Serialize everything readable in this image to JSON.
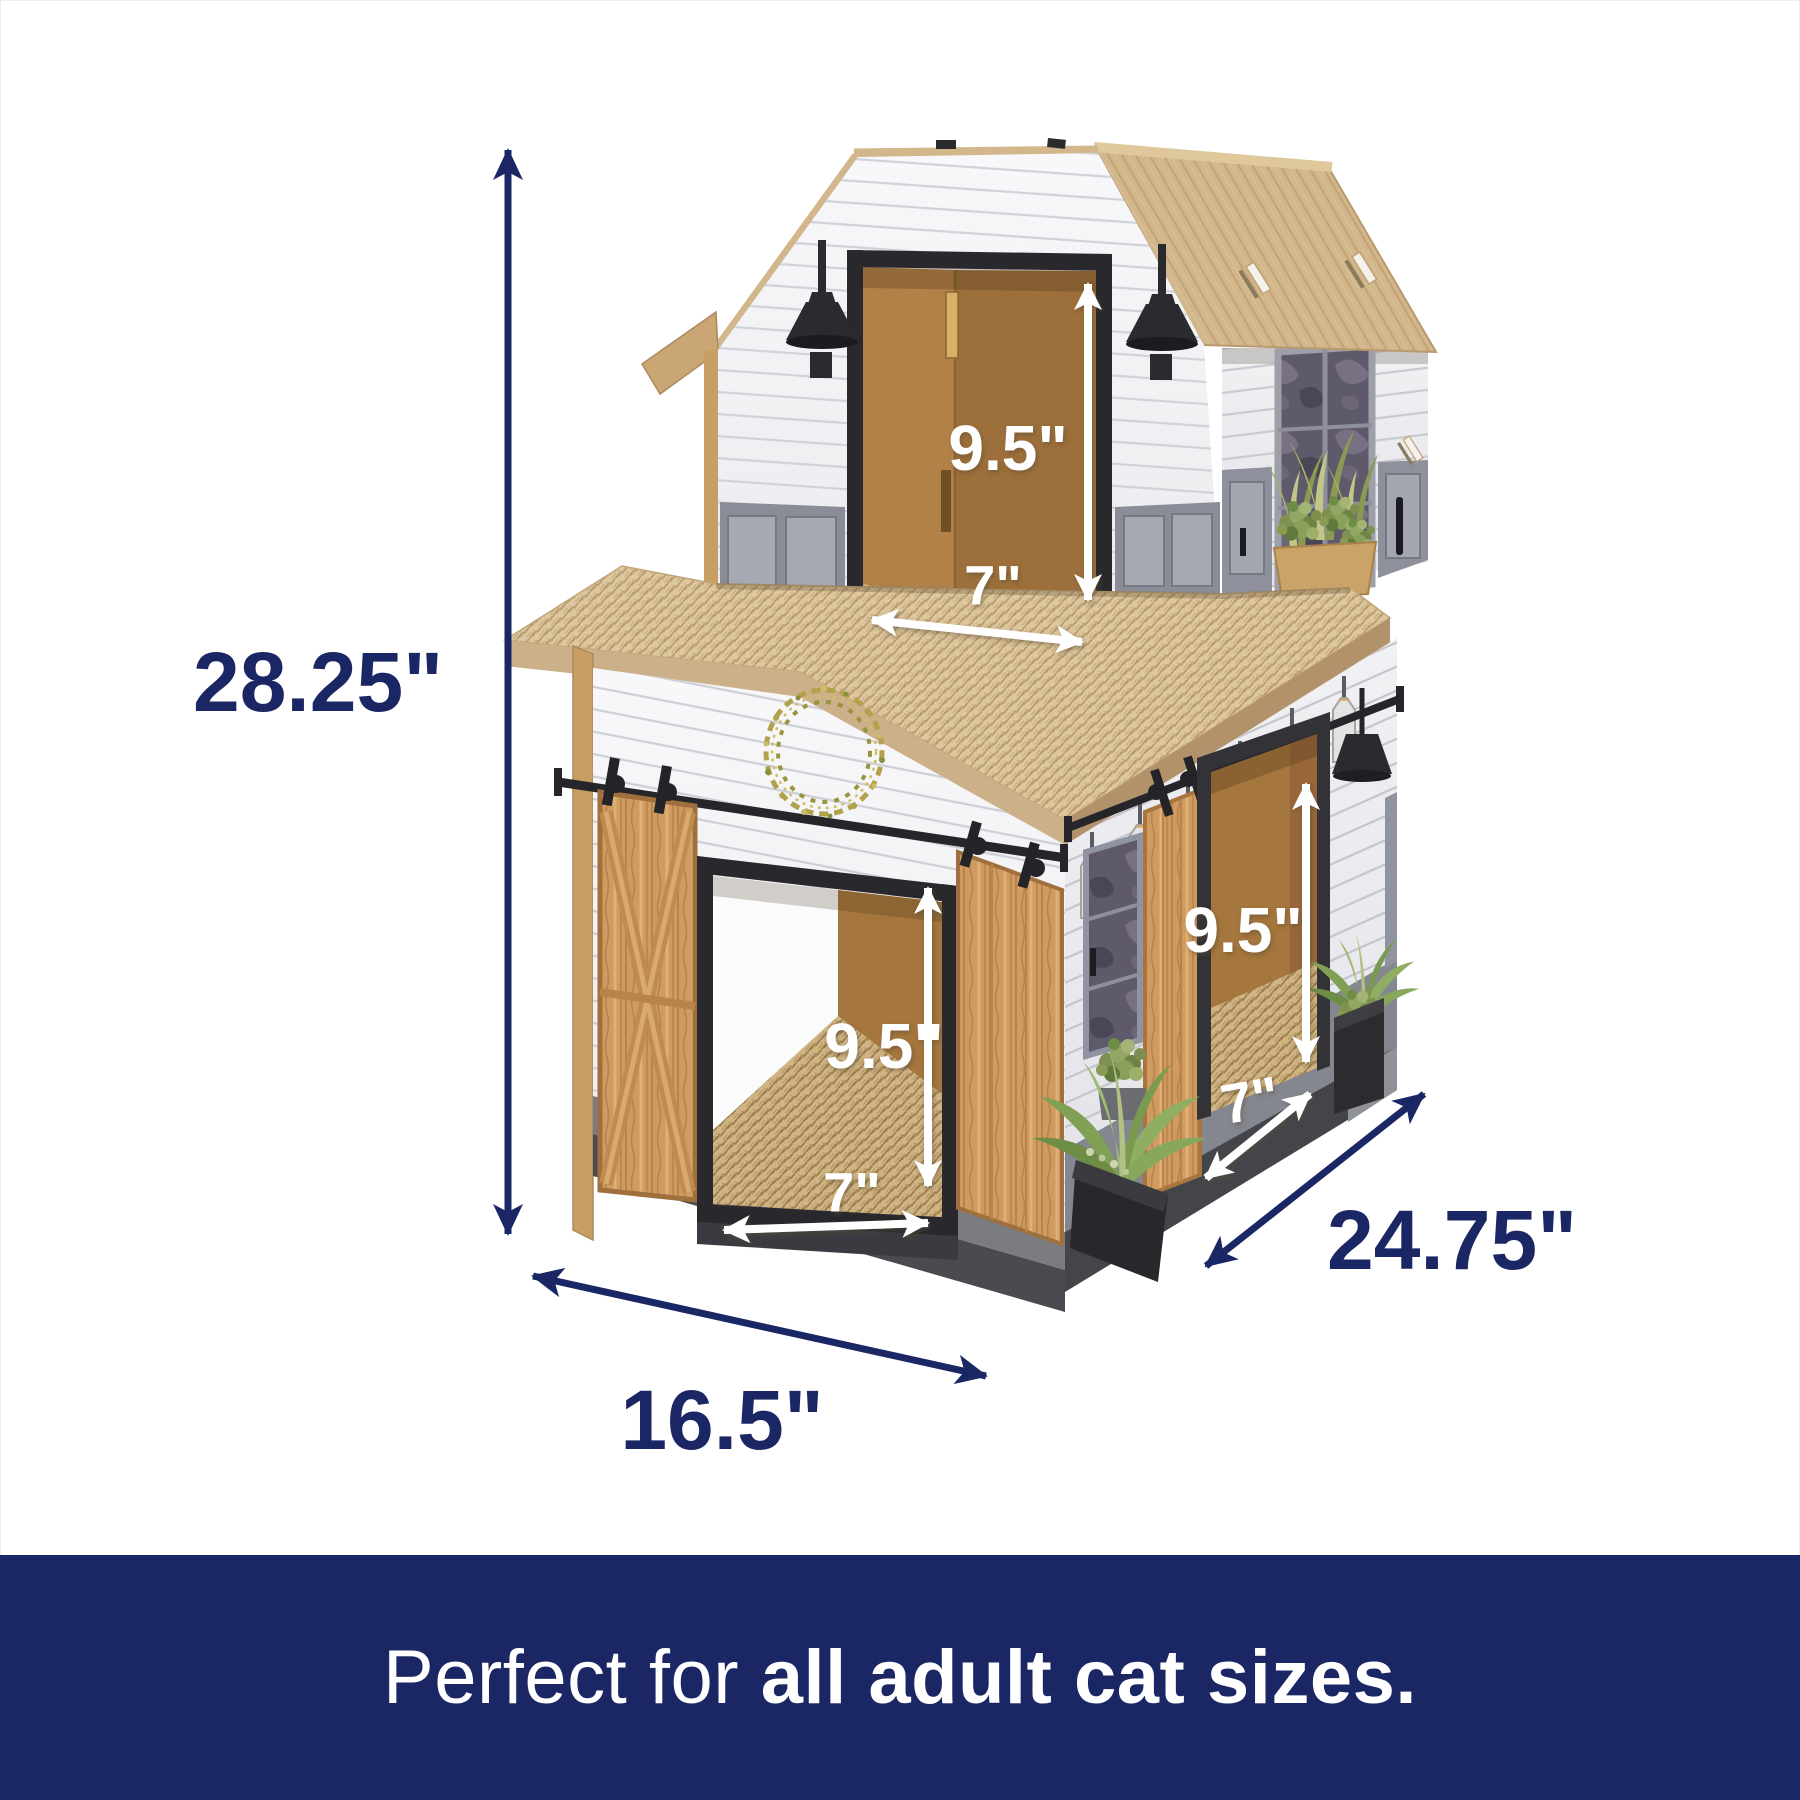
{
  "caption": {
    "prefix": "Perfect for ",
    "emphasis": "all adult cat sizes."
  },
  "dimensions": {
    "overall_height": "28.25\"",
    "base_width": "16.5\"",
    "base_depth": "24.75\"",
    "loft_door": {
      "height": "9.5\"",
      "width": "7\""
    },
    "front_door": {
      "height": "9.5\"",
      "width": "7\""
    },
    "side_door": {
      "height": "9.5\"",
      "width": "7\""
    }
  },
  "colors": {
    "navy": "#1b2765",
    "label_white": "#ffffff",
    "roof_tan": "#d3b78c",
    "cardboard_edge": "#c79e63",
    "wood_door": "#cf9b60",
    "scratcher_corrugate": "#dcc79f",
    "trim_gray": "#8a8d96",
    "hardware_black": "#26262a"
  }
}
